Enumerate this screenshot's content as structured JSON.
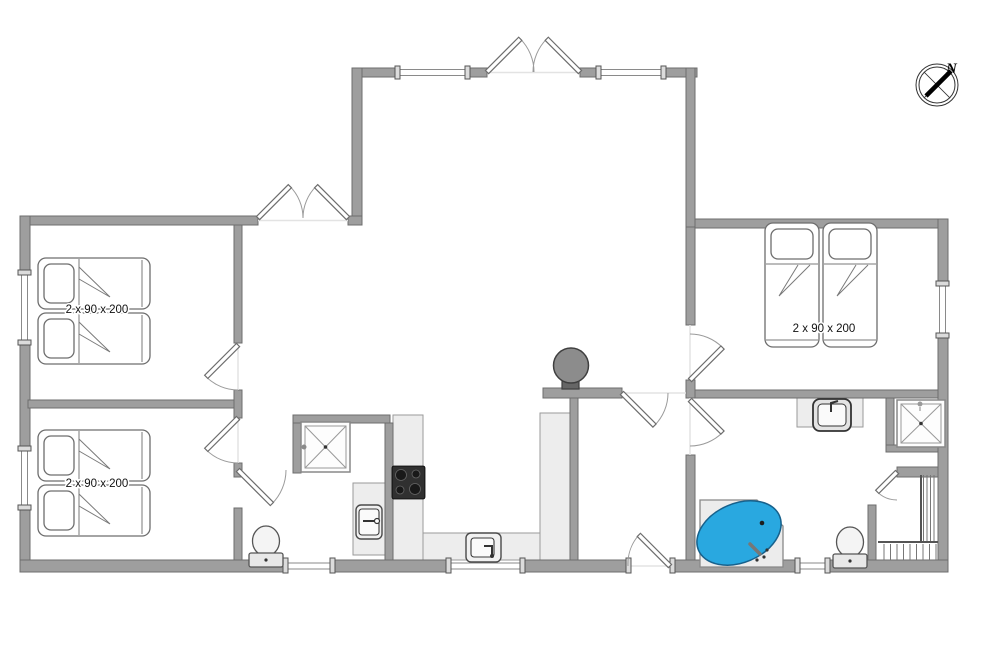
{
  "plan": {
    "type": "house-floor-plan",
    "labels": {
      "bed_size": "2 x 90 x 200"
    },
    "compass": {
      "north_label": "N"
    },
    "colors": {
      "background": "#ffffff",
      "wall": "#9e9e9e",
      "wall_outline": "#6d6d6d",
      "counter": "#ededed",
      "stove": "#303030",
      "spa_water": "#29a8e0",
      "fireplace": "#8c8c8c"
    },
    "fixtures": [
      "double-bed-top-left",
      "double-bed-bottom-left",
      "double-bed-right",
      "french-doors-top",
      "french-doors-left-wing",
      "entrance-door-bottom",
      "kitchen-stove",
      "kitchen-sink",
      "shower-left",
      "washbasin-left",
      "toilet-left",
      "vanity-sink-right",
      "shower-right",
      "spa-bath",
      "toilet-right",
      "wood-burning-stove",
      "staircase",
      "compass-rose"
    ]
  }
}
